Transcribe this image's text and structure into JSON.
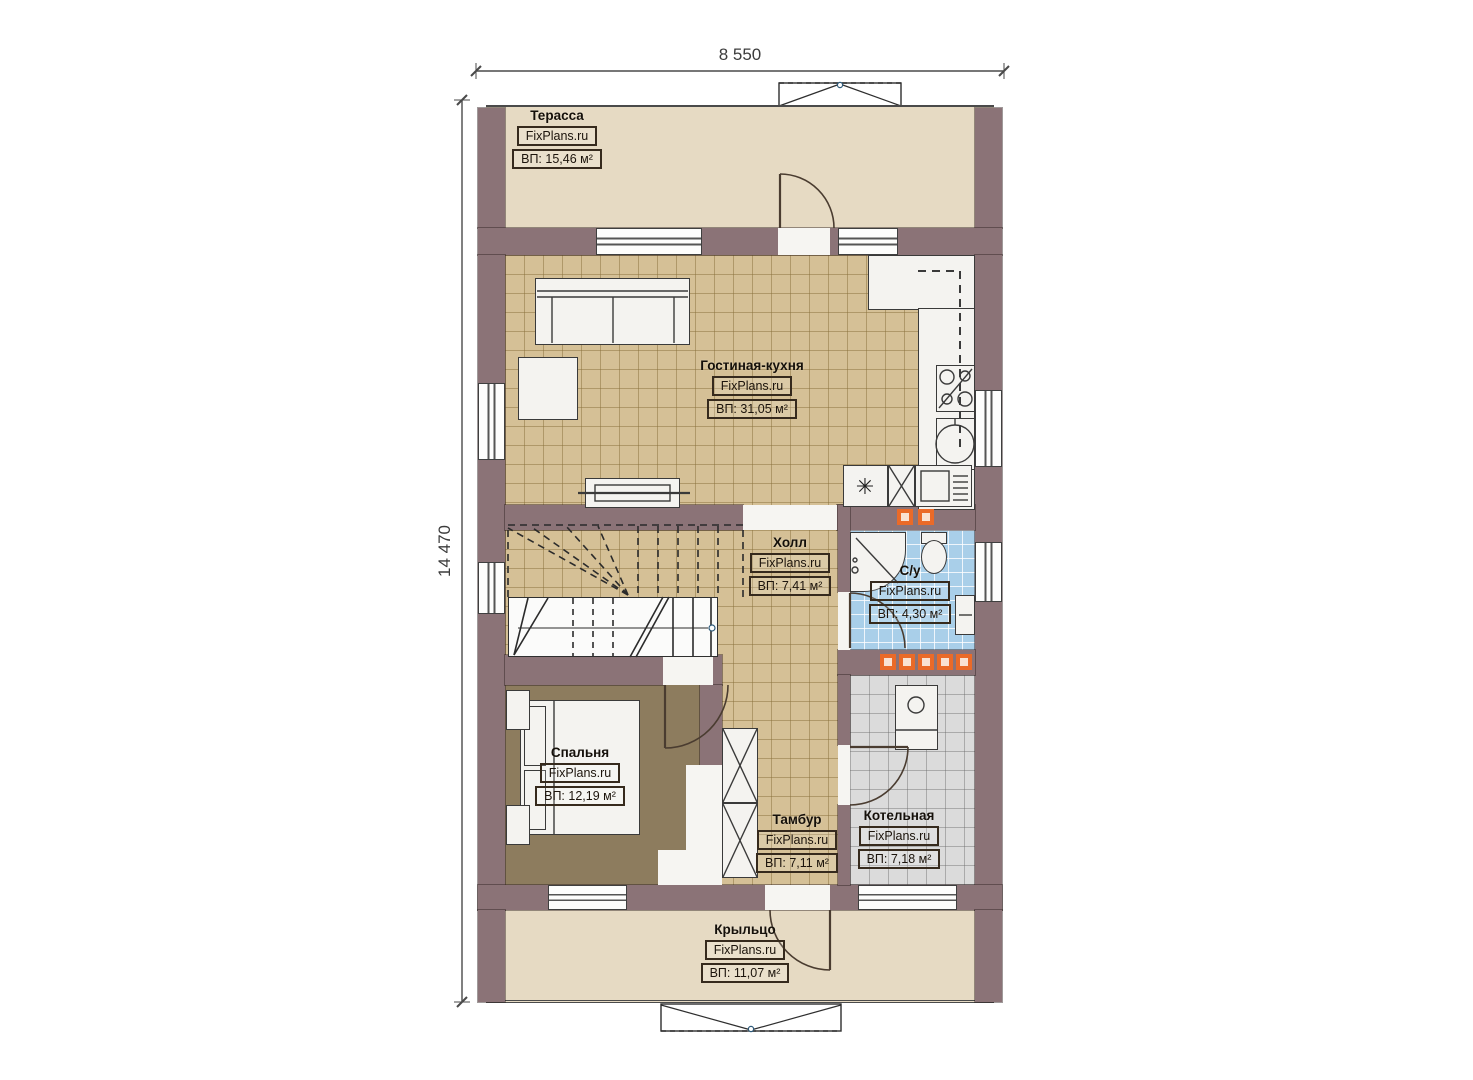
{
  "plan": {
    "type": "floor-plan",
    "dimensions": {
      "width_label": "8 550",
      "height_label": "14 470"
    },
    "watermark": "FixPlans.ru",
    "rooms": {
      "terrace": {
        "name": "Терасса",
        "brand": "FixPlans.ru",
        "area": "ВП: 15,46 м²"
      },
      "living": {
        "name": "Гостиная-кухня",
        "brand": "FixPlans.ru",
        "area": "ВП: 31,05 м²"
      },
      "hall": {
        "name": "Холл",
        "brand": "FixPlans.ru",
        "area": "ВП: 7,41 м²"
      },
      "bathroom": {
        "name": "С/у",
        "brand": "FixPlans.ru",
        "area": "ВП: 4,30 м²"
      },
      "bedroom": {
        "name": "Спальня",
        "brand": "FixPlans.ru",
        "area": "ВП: 12,19 м²"
      },
      "tambour": {
        "name": "Тамбур",
        "brand": "FixPlans.ru",
        "area": "ВП: 7,11 м²"
      },
      "boiler": {
        "name": "Котельная",
        "brand": "FixPlans.ru",
        "area": "ВП: 7,18 м²"
      },
      "porch": {
        "name": "Крыльцо",
        "brand": "FixPlans.ru",
        "area": "ВП: 11,07 м²"
      }
    },
    "colors": {
      "wall": "#8b7377",
      "terrace_floor": "#e6dac3",
      "living_tile": "#d5c096",
      "bathroom_tile": "#a9cfe9",
      "boiler_tile": "#dbdbdb",
      "bedroom_floor": "#8d7c5e",
      "heater_accent": "#ea6a28"
    },
    "symbols": [
      "entry-steps-top",
      "entry-steps-bottom",
      "stairs",
      "doors",
      "windows",
      "heaters"
    ]
  }
}
